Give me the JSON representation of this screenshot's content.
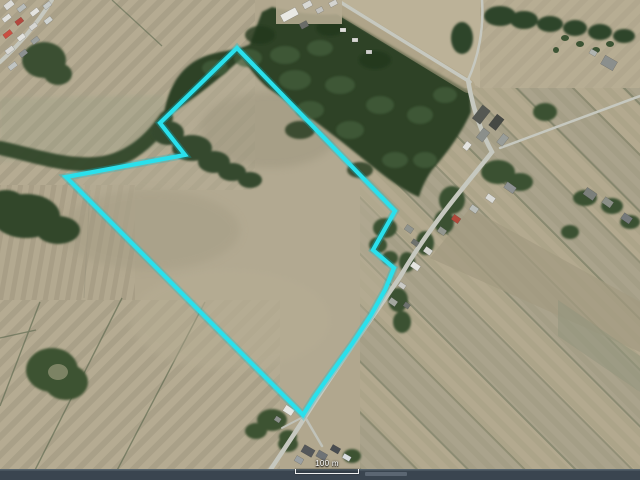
{
  "map": {
    "kind": "aerial-photo-with-property-outline",
    "scale_bar": {
      "label": "100 m"
    },
    "boundary": {
      "color": "#2ae0ec",
      "points": [
        [
          237,
          48
        ],
        [
          160,
          123
        ],
        [
          185,
          155
        ],
        [
          66,
          177
        ],
        [
          303,
          415
        ],
        [
          315,
          396
        ],
        [
          332,
          372
        ],
        [
          352,
          344
        ],
        [
          371,
          315
        ],
        [
          385,
          290
        ],
        [
          394,
          268
        ],
        [
          373,
          250
        ],
        [
          395,
          211
        ]
      ]
    }
  },
  "colors": {
    "field_base": "#b1a78e",
    "forest": "#2d4227",
    "road": "#c6c8bf",
    "highway": "#3a4550",
    "boundary": "#2ae0ec"
  }
}
